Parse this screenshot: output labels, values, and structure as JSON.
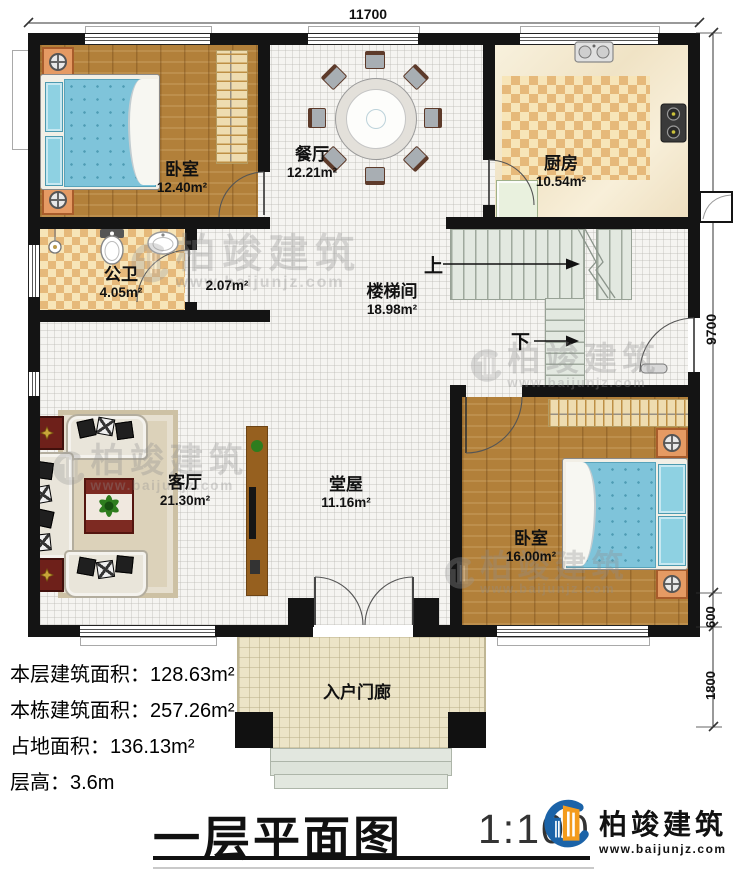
{
  "dimensions": {
    "top": "11700",
    "side_total": "9700",
    "side_step": "600",
    "side_porch": "1800"
  },
  "rooms": {
    "bedroom_tl": {
      "name": "卧室",
      "area": "12.40m²"
    },
    "dining": {
      "name": "餐厅",
      "area": "12.21m²"
    },
    "kitchen": {
      "name": "厨房",
      "area": "10.54m²"
    },
    "bathroom": {
      "name": "公卫",
      "area": "4.05m²"
    },
    "corridor": {
      "area": "2.07m²"
    },
    "stairhall": {
      "name": "楼梯间",
      "area": "18.98m²"
    },
    "living": {
      "name": "客厅",
      "area": "21.30m²"
    },
    "hall": {
      "name": "堂屋",
      "area": "11.16m²"
    },
    "bedroom_br": {
      "name": "卧室",
      "area": "16.00m²"
    },
    "porch": {
      "name": "入户门廊"
    }
  },
  "stairs": {
    "up": "上",
    "down": "下"
  },
  "stats": [
    {
      "label": "本层建筑面积：",
      "value": "128.63m²"
    },
    {
      "label": "本栋建筑面积：",
      "value": "257.26m²"
    },
    {
      "label": "占地面积：",
      "value": "136.13m²"
    },
    {
      "label": "层高：",
      "value": "3.6m"
    }
  ],
  "title": {
    "text": "一层平面图",
    "scale": "1:100"
  },
  "brand": {
    "name": "柏竣建筑",
    "url": "www.baijunjz.com"
  },
  "watermark": {
    "name": "柏竣建筑",
    "url": "www.baijunjz.com"
  },
  "colors": {
    "wall": "#141414",
    "wood": "#b2803a",
    "bed": "#7fc4da",
    "tile": "#e6b97a",
    "brand_blue": "#1b63a8",
    "brand_orange": "#f39b1d"
  }
}
